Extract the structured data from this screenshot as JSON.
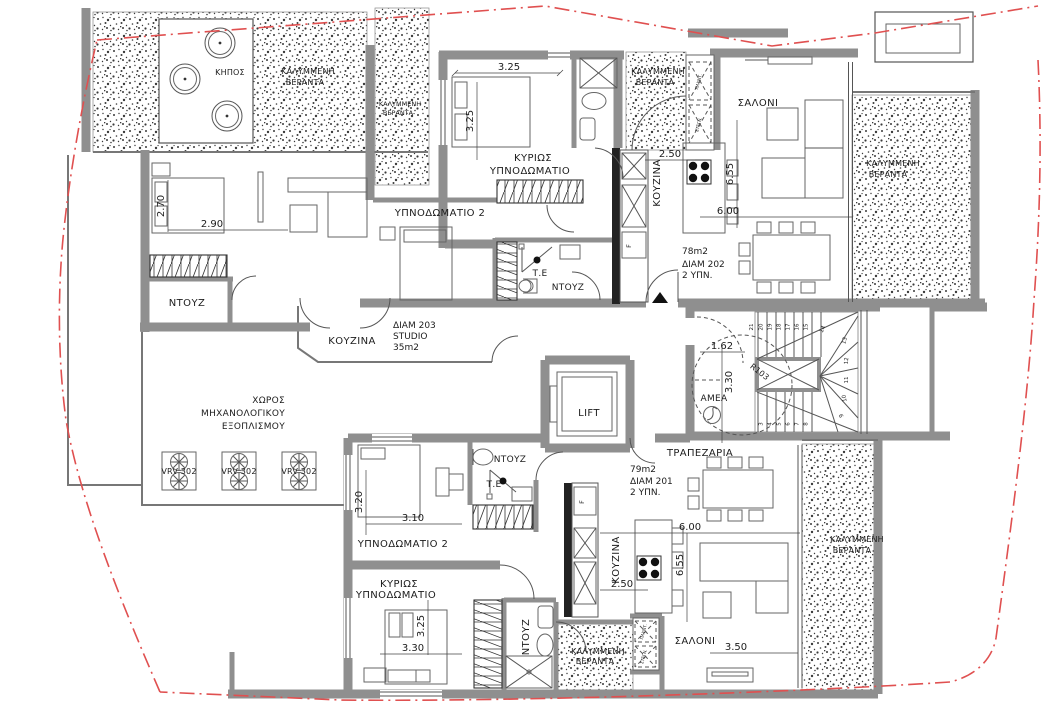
{
  "meta": {
    "drawing_type": "architectural floor plan",
    "language": "Greek",
    "boundary_color": "#e05050",
    "wall_color": "#8f8f8f"
  },
  "rooms": {
    "garden": "ΚΗΠΟΣ",
    "veranda_l1": "ΚΑΛΥΜΜΕΝΗ",
    "veranda_l2": "ΒΕΡΑΝΤΑ",
    "master_l1": "ΚΥΡΙΩΣ",
    "master_l2": "ΥΠΝΟΔΩΜΑΤΙΟ",
    "bedroom2": "ΥΠΝΟΔΩΜΑΤΙΟ 2",
    "living": "ΣΑΛΟΝΙ",
    "kitchen": "ΚΟΥΖΙΝΑ",
    "dining": "ΤΡΑΠΕΖΑΡΙΑ",
    "shower": "ΝΤΟΥΖ",
    "shower_te": "Τ.Ε",
    "lift": "LIFT",
    "accessible_wc": "ΑΜΕΑ",
    "stair_radius_ref": "R103",
    "mech_l1": "ΧΩΡΟΣ",
    "mech_l2": "ΜΗΧΑΝΟΛΟΓΙΚΟΥ",
    "mech_l3": "ΕΞΟΠΛΙΣΜΟΥ",
    "vrv_unit": "VRV 302",
    "fridge": "F",
    "washer": "ΠΛΥΝΤ.",
    "dryer": "ΣΤΕΓΝ."
  },
  "apartments": {
    "apt202": {
      "area": "78m2",
      "id": "ΔΙΑΜ 202",
      "beds": "2 ΥΠΝ."
    },
    "apt201": {
      "area": "79m2",
      "id": "ΔΙΑΜ 201",
      "beds": "2 ΥΠΝ."
    },
    "apt203": {
      "id": "ΔΙΑΜ 203",
      "type": "STUDIO",
      "area": "35m2"
    }
  },
  "dimensions": {
    "d162": "1.62",
    "d250": "2.50",
    "d270": "2.70",
    "d290": "2.90",
    "d310": "3.10",
    "d320": "3.20",
    "d325": "3.25",
    "d330": "3.30",
    "d350": "3.50",
    "d600": "6.00",
    "d655": "6.55"
  },
  "stairs": {
    "steps_upper": [
      "21",
      "20",
      "19",
      "18",
      "17",
      "16",
      "15",
      "14"
    ],
    "steps_right": [
      "13",
      "12",
      "11",
      "10",
      "9"
    ],
    "steps_lower": [
      "3",
      "4",
      "5",
      "6",
      "7",
      "8"
    ]
  }
}
